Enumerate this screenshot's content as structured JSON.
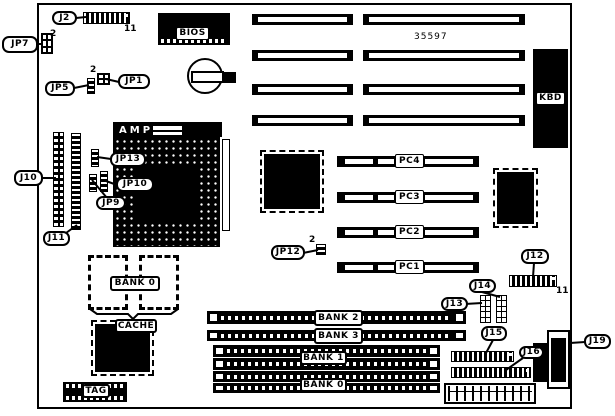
{
  "colors": {
    "ink": "#000000",
    "paper": "#ffffff"
  },
  "board": {
    "part_number": "35597",
    "components": {
      "bios": "BIOS",
      "cpu_socket_brand": "AMP",
      "keyboard_connector": "KBD"
    },
    "callouts": {
      "j2": "J2",
      "jp7": "JP7",
      "jp5": "JP5",
      "jp1": "JP1",
      "j10": "J10",
      "j11": "J11",
      "jp13": "JP13",
      "jp10": "JP10",
      "jp9": "JP9",
      "jp12": "JP12",
      "j12": "J12",
      "j13": "J13",
      "j14": "J14",
      "j15": "J15",
      "j16": "J16",
      "j19": "J19",
      "cache_bank": "BANK 0",
      "cache": "CACHE",
      "tag": "TAG"
    },
    "pins": {
      "j2": "11",
      "jp7": "2",
      "jp1": "2",
      "jp12": "2",
      "j12": "11"
    },
    "pci_slots": [
      "PC4",
      "PC3",
      "PC2",
      "PC1"
    ],
    "memory_banks": [
      "BANK 2",
      "BANK 3",
      "BANK 1",
      "BANK 0"
    ]
  }
}
